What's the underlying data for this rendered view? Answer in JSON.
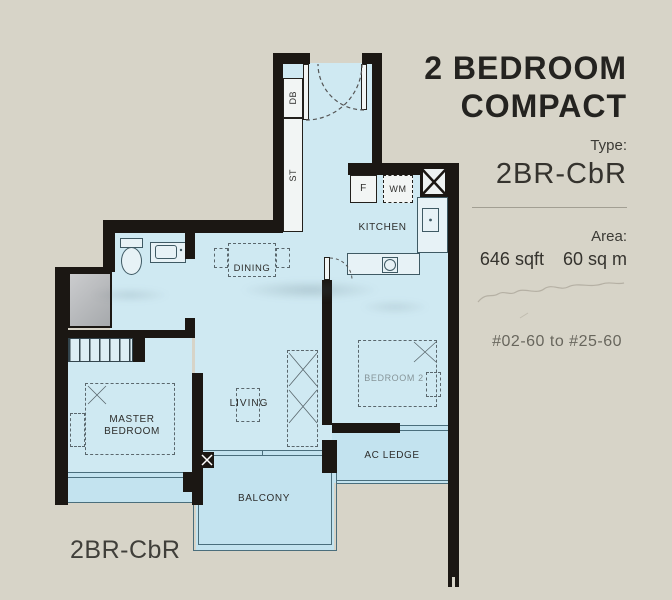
{
  "panel": {
    "title_line1": "2 BEDROOM",
    "title_line2": "COMPACT",
    "type_label": "Type:",
    "type_value": "2BR-CbR",
    "area_label": "Area:",
    "area_sqft": "646 sqft",
    "area_sqm": "60 sq m",
    "units_line": "#02-60 to #25-60"
  },
  "plan": {
    "footer_label": "2BR-CbR",
    "labels": {
      "kitchen": "KITCHEN",
      "dining": "DINING",
      "living": "LIVING",
      "master_line1": "MASTER",
      "master_line2": "BEDROOM",
      "bedroom2": "BEDROOM 2",
      "balcony": "BALCONY",
      "ac_ledge": "AC LEDGE",
      "db": "DB",
      "st": "ST",
      "fridge": "F",
      "washer": "WM"
    }
  },
  "colors": {
    "background": "#d7d4c8",
    "floor": "#cfe9f2",
    "floor_secondary": "#c3e3ef",
    "wall": "#1b1713",
    "title_text": "#242320",
    "plan_line": "#4a6e7c"
  }
}
